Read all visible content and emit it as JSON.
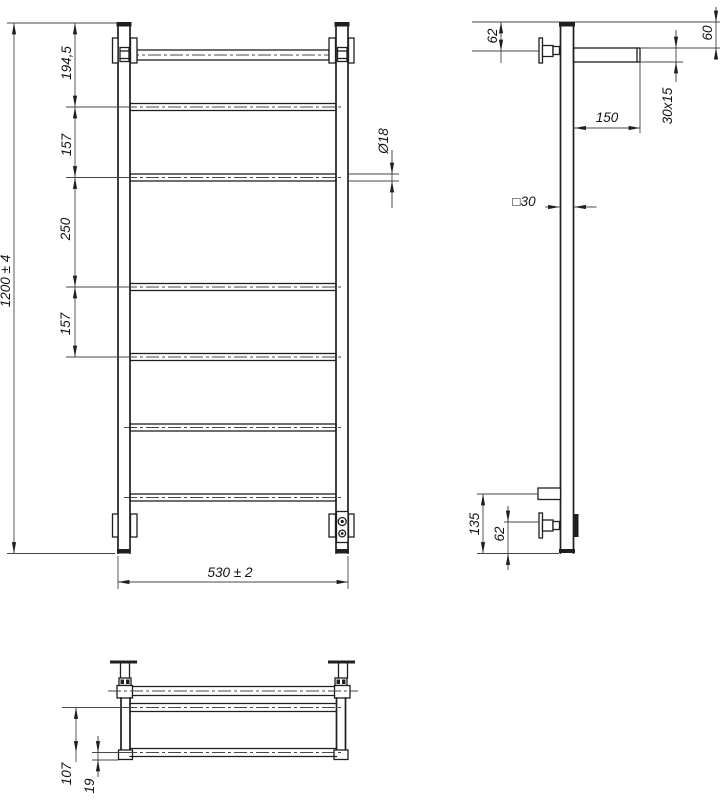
{
  "drawing": {
    "background_color": "#ffffff",
    "line_color": "#1f1f1f",
    "front": {
      "height": "1200 ± 4",
      "top_segment": "194,5",
      "gap_1": "157",
      "gap_2": "250",
      "gap_3": "157",
      "rung_diameter": "Ø18",
      "width": "530 ± 2"
    },
    "side": {
      "bracket_offset_top": "62",
      "bar_offset_top": "60",
      "bar_length": "150",
      "bar_profile": "30x15",
      "post_profile": "□30",
      "bottom_bracket_offset": "135",
      "bottom_valve_offset": "62"
    },
    "top": {
      "depth": "107",
      "offset": "19"
    }
  }
}
